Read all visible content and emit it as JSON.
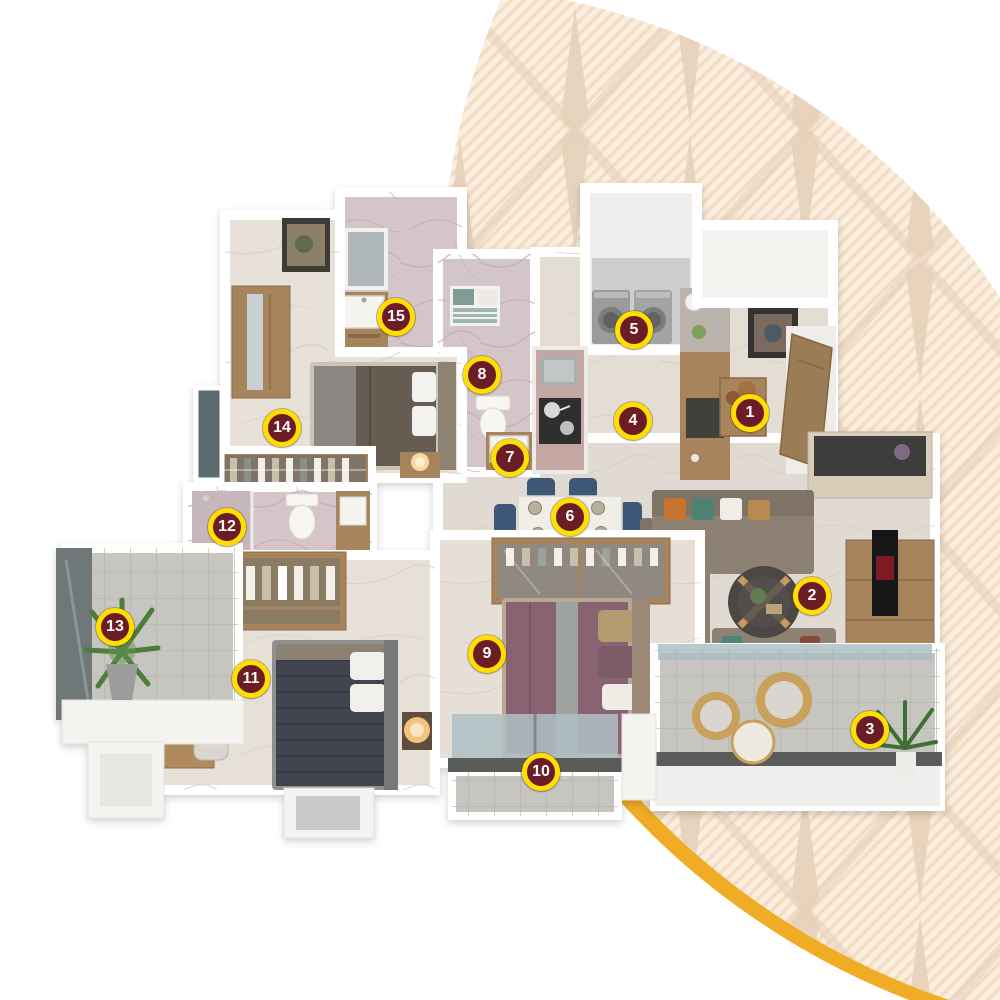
{
  "page": {
    "width": 1000,
    "height": 1000,
    "background": "#FFFFFF"
  },
  "decor": {
    "pattern_base": "#FBEEDE",
    "pattern_stripe": "#F2DCC4",
    "pattern_motif": "#E6D0B9",
    "arc_gold": "#EFAC24"
  },
  "palette": {
    "wall": "#F4F3F0",
    "floor": "#E3DDD4",
    "marble": "#D4C5C9",
    "balcony_tile": "#C7C5C0",
    "wood": "#A8845C",
    "glass": "#A9BCC0",
    "sofa": "#8C8172",
    "bed_mauve": "#8A6473",
    "bed_dark": "#40454F",
    "bed_brown": "#665B51",
    "chair_navy": "#3E5877",
    "rail_dark": "#5A5B5A"
  },
  "markers": {
    "style": {
      "fill": "#6B1C25",
      "ring": "#FFDF00",
      "text": "#FFFFFF",
      "diameter": 38
    },
    "items": [
      {
        "number": "1",
        "x": 750,
        "y": 413
      },
      {
        "number": "2",
        "x": 812,
        "y": 596
      },
      {
        "number": "3",
        "x": 870,
        "y": 730
      },
      {
        "number": "4",
        "x": 633,
        "y": 421
      },
      {
        "number": "5",
        "x": 634,
        "y": 330
      },
      {
        "number": "6",
        "x": 570,
        "y": 517
      },
      {
        "number": "7",
        "x": 510,
        "y": 458
      },
      {
        "number": "8",
        "x": 482,
        "y": 375
      },
      {
        "number": "9",
        "x": 487,
        "y": 654
      },
      {
        "number": "10",
        "x": 541,
        "y": 772
      },
      {
        "number": "11",
        "x": 251,
        "y": 679
      },
      {
        "number": "12",
        "x": 227,
        "y": 527
      },
      {
        "number": "13",
        "x": 115,
        "y": 627
      },
      {
        "number": "14",
        "x": 282,
        "y": 428
      },
      {
        "number": "15",
        "x": 396,
        "y": 317
      }
    ]
  }
}
